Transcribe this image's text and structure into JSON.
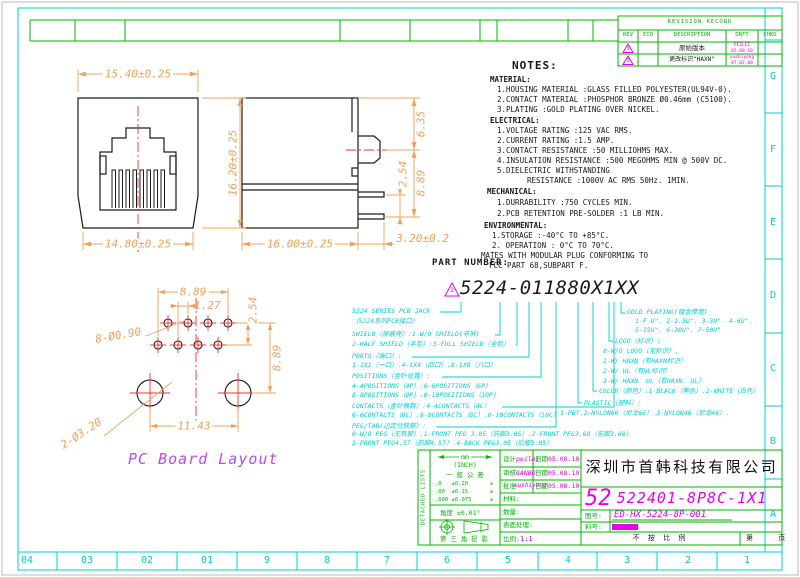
{
  "colors": {
    "border_cyan": "#00cfcf",
    "table_green": "#00b400",
    "value_magenta": "#e800e8",
    "dimension_orange": "#f0a05a",
    "centerline_red": "#ff2a2a",
    "line_black": "#1a1a1a",
    "caption_violet": "#b84ce8"
  },
  "zones": {
    "bottom": [
      "04",
      "03",
      "02",
      "01",
      "9",
      "8",
      "7",
      "6",
      "5",
      "4",
      "3",
      "2",
      "1"
    ],
    "right": [
      "G",
      "F",
      "E",
      "D",
      "C",
      "B",
      "A"
    ]
  },
  "revision_table": {
    "title": "REVISION RECORD",
    "headers": [
      "REV",
      "ECO",
      "DESCRIPTION",
      "DRFT",
      "CHKD"
    ],
    "rows": [
      {
        "rev": "1",
        "eco": "",
        "desc": "原始版本",
        "drft_name": "PEILEI",
        "drft_date": "05.08.10",
        "chkd": ""
      },
      {
        "rev": "2",
        "eco": "",
        "desc": "更改标识\"HAXN\"",
        "drft_name": "xushiyong",
        "drft_date": "07.02.08",
        "chkd": ""
      }
    ]
  },
  "notes": {
    "heading": "NOTES:",
    "material_title": "MATERIAL:",
    "material": [
      "1.HOUSING MATERIAL :GLASS FILLED POLYESTER(UL94V-0).",
      "2.CONTACT MATERIAL :PHOSPHOR BRONZE Ø0.46mm (C5100).",
      "3.PLATING :GOLD PLATING OVER NICKEL."
    ],
    "electrical_title": "ELECTRICAL:",
    "electrical": [
      "1.VOLTAGE RATING :125 VAC RMS.",
      "2.CURRENT RATING :1.5 AMP.",
      "3.CONTACT RESISTANCE :50 MILLIOHMS MAX.",
      "4.INSULATION RESISTANCE :500 MEGOHMS MIN @ 500V DC.",
      "5.DIELECTRIC WITHSTANDING",
      "RESISTANCE :1000V AC RMS 50Hz. 1MIN."
    ],
    "mechanical_title": "MECHANICAL:",
    "mechanical": [
      "1.DURRABILITY :750 CYCLES MIN.",
      "2.PCB RETENTION PRE-SOLDER :1 LB MIN."
    ],
    "environmental_title": "ENVIRONMENTAL:",
    "environmental": [
      "1.STORAGE :-40°C TO +85°C.",
      "2. OPERATION : 0°C TO 70°C."
    ],
    "footer": [
      "MATES WITH MODULAR PLUG CONFORMING TO",
      "FCC PART 68,SUBPART F."
    ]
  },
  "views": {
    "front": {
      "dim_top": "15.40±0.25",
      "dim_height": "16.20±0.25",
      "dim_bottom": "14.80±0.25"
    },
    "side": {
      "dim_depth": "16.00±0.25",
      "dim_latch": "6.35",
      "dim_pin_pitch": "2.54",
      "dim_pin_row": "8.89",
      "dim_pin_len": "3.20±0.2"
    },
    "pcb": {
      "dim_span_top": "8.89",
      "dim_stagger": "1.27",
      "dim_row_gap": "2.54",
      "dim_span_right": "8.89",
      "dim_mount_span": "11.43",
      "label_small_holes": "8-Ø0.90",
      "label_mount_holes": "2-Ø3.20",
      "caption": "PC Board Layout"
    }
  },
  "part_number": {
    "label": "PART NUMBER:",
    "rev_mark": "2",
    "value": "5224-011880X1XX",
    "left_lines": [
      "5224 SERIES PCB JACK",
      "（5224系列PCB接口）",
      "SHIELD（屏蔽壳）:1-W/O SHIELD(非屏)",
      "2-HALF SHIELD（半包）:3-FULL SHIELD（全包）",
      "PORTS（端口）:",
      "1-1X1（一口）.4-1X4（四口）.8-1X8（八口）",
      "POSITIONS（金针位置）:",
      "4-4POSITIONS（4P）:6-6POSITIONS（6P）",
      "8-8POSITIONS（8P）:0-10POSITIONS（10P）",
      "CONTACTS（金针根数）:4-4CONTACTS（4C）",
      "6-6CONTACTS（6C）.8-8CONTACTS（8C）.0-10CONTACTS（10C）",
      "PEG/TAB(边定位铁脚）:",
      "0-W/O PEG（无铁脚）.1-FRONT PEG 3.05（前脚3.05）.2-FRONT PEG3.68（前脚3.68）",
      "3-FRONT PEG4.57（前脚4.57）.4-BACK PEG3.05（后脚3.05）"
    ],
    "right_lines": [
      "GOLD PLATING(镀金厚度)",
      "1-F U\". 2-1.5U\". 3-3U\". 4-6U\".",
      "5-15U\". 6-30U\". 7-50U\"",
      "LOGO（标识）:",
      "0-W/O LOGO（无标识）.",
      "1-W/ HAXN（有HAXN标识）",
      "2-W/ UL（有UL标识）",
      "3-W/ HAXN. UL（有HAXN. UL）",
      "COLOR（颜色）:1-BLACK（黑色）.2-WHITE（白色）",
      "PLASTIC（塑料）:",
      "1-PBT.2-NYLON66（尼龙66）.3-NYLON46（尼龙46）."
    ]
  },
  "title_block": {
    "side_note": "DETACHED LISTS",
    "units_mm": "mm",
    "units_inch": "(INCH)",
    "general_tol": "一 般 公 差",
    "tol_rows": [
      ".0   ±0.20",
      ".00  ±0.15",
      ".000 ±0.075"
    ],
    "tol_pm": "±",
    "angle_tol": "角度 ±0.01°",
    "projection_label": "第 三 角 投 影",
    "rows": [
      {
        "label": "设计",
        "value": "peilei",
        "date_label": "日期",
        "date": "05.08.10"
      },
      {
        "label": "审核",
        "value": "GANBO",
        "date_label": "日期",
        "date": "05.08.10"
      },
      {
        "label": "批准",
        "value": "xushiyong",
        "date_label": "日期",
        "date": "05.08.10"
      },
      {
        "label": "材料:",
        "value": "",
        "date_label": "",
        "date": ""
      },
      {
        "label": "数量:",
        "value": "",
        "date_label": "",
        "date": ""
      },
      {
        "label": "表面处理:",
        "value": "",
        "date_label": "",
        "date": ""
      },
      {
        "label": "比例:",
        "value": "1:1",
        "date_label": "",
        "date": ""
      }
    ],
    "company": "深圳市首韩科技有限公司",
    "size_code": "52",
    "part_no": "522401-8P8C-1X1",
    "dwg_no_label": "图号:",
    "dwg_no": "ED-HX-5224-8P-001",
    "mat_no_label": "料号:",
    "no_scale": "不 按 比 例",
    "sheet_label": "第      页"
  }
}
